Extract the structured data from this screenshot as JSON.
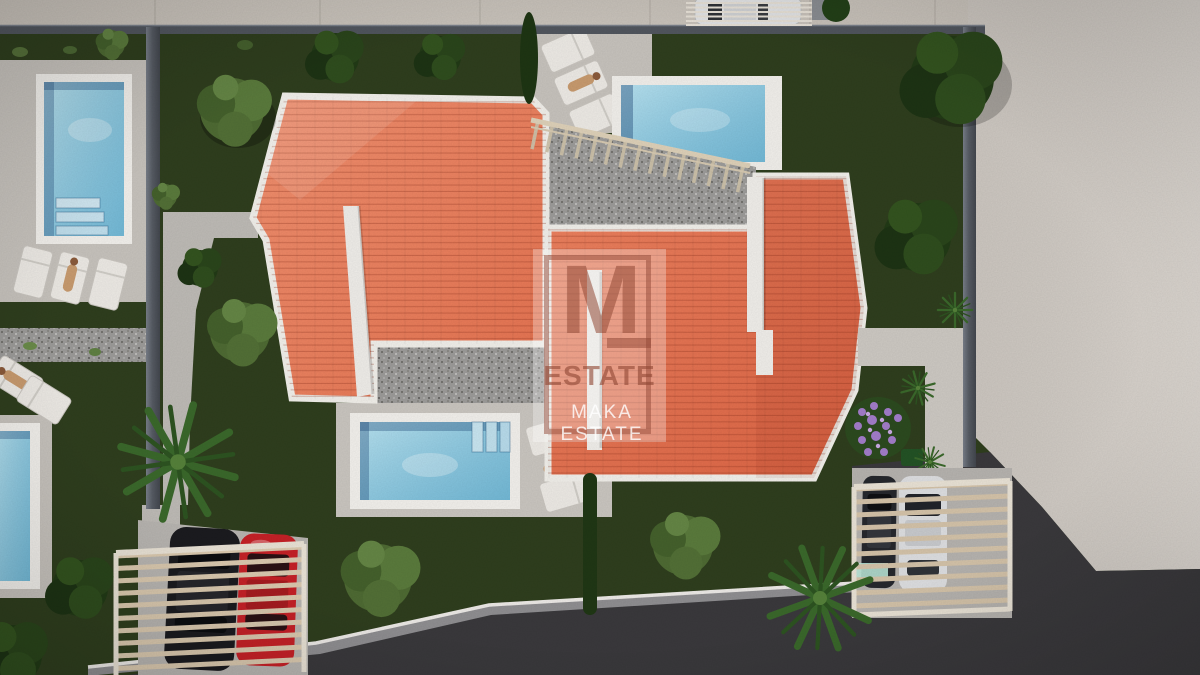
{
  "watermark": {
    "monogram": "M",
    "brand": "ESTATE",
    "subbrand": "MAKA ESTATE"
  },
  "scene": {
    "type": "aerial 3D architectural render of two semi-detached villas",
    "elements": [
      "two orange hip roofs with white ridge caps and parapet walls",
      "three swimming pools with white surrounds and steps",
      "sun loungers with sunbathing figures",
      "gravel terraces and bands",
      "stair railing between roof terraces",
      "two wooden-slat carports (black car, red car, dark car, white car)",
      "white car parked on street at top",
      "dark boundary walls, lawns, trees, two palm trees, purple flower bed",
      "grey sidewalk at top, beige open ground at right, dark asphalt road at bottom"
    ]
  },
  "colors": {
    "roof_left": "#e8795b",
    "roof_right": "#e06c4c",
    "roof_ridge": "#f1efeb",
    "pool_water": "#8fd0e6",
    "lawn": "#2f3e1e",
    "sidewalk": "#c9c3bb",
    "open_ground": "#d8d2cb",
    "asphalt": "#3a393c",
    "boundary_wall": "#565b63",
    "gravel": "#9c9b99",
    "pergola_wood": "#d3c2a8",
    "car_red": "#c42127",
    "car_black": "#1b1b1f",
    "car_white": "#e2e3e5",
    "flowers": "#a27cc9",
    "watermark_tint": "rgba(146,72,53,0.55)",
    "watermark_panel": "rgba(255,255,255,0.30)",
    "watermark_subtext": "rgba(255,255,255,0.80)"
  }
}
